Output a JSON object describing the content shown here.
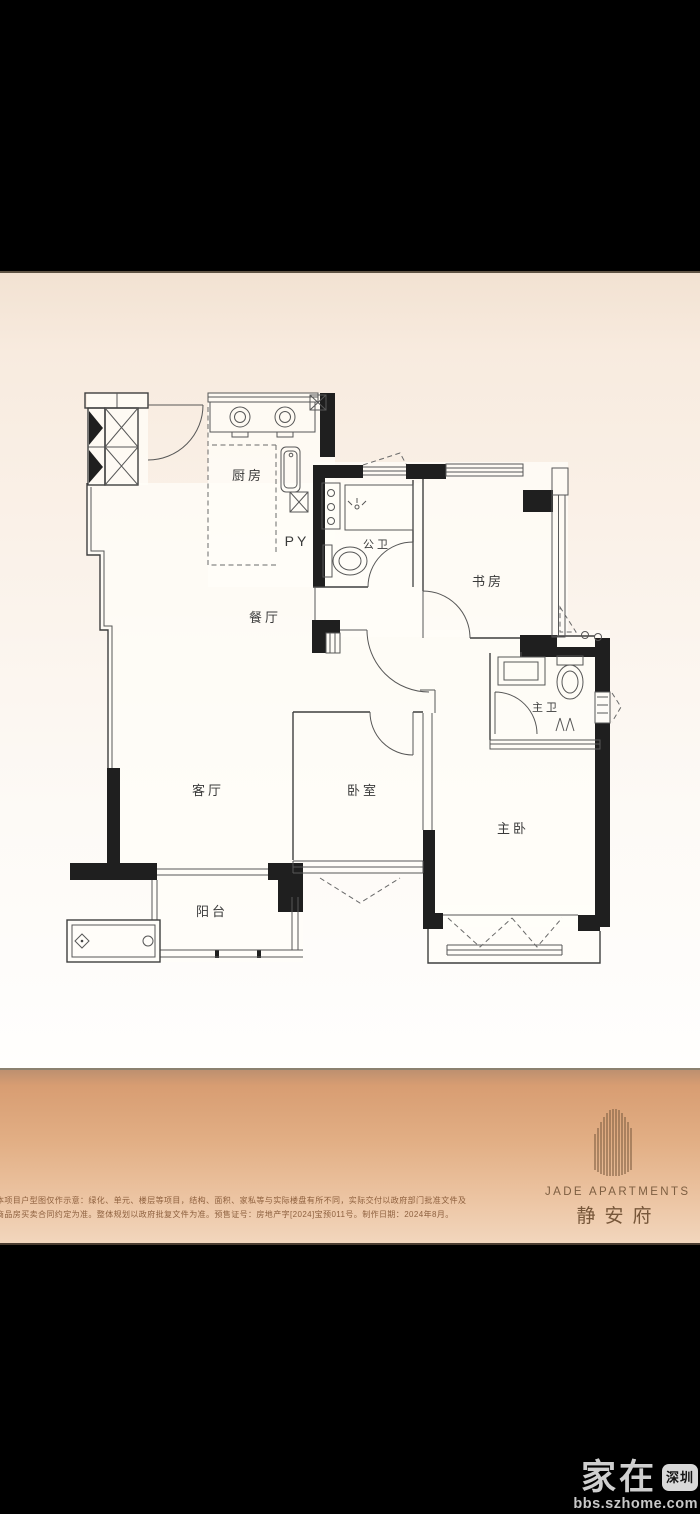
{
  "floor_plan": {
    "rooms": [
      {
        "id": "kitchen",
        "label": "厨房"
      },
      {
        "id": "dining-room",
        "label": "餐厅"
      },
      {
        "id": "living-room",
        "label": "客厅"
      },
      {
        "id": "balcony",
        "label": "阳台"
      },
      {
        "id": "bedroom",
        "label": "卧室"
      },
      {
        "id": "master-bedroom",
        "label": "主卧"
      },
      {
        "id": "study",
        "label": "书房"
      },
      {
        "id": "guest-bathroom",
        "label": "公卫"
      },
      {
        "id": "master-bathroom",
        "label": "主卫"
      }
    ],
    "annotations": {
      "pipe_shaft": "PY"
    }
  },
  "branding": {
    "logo_en": "JADE APARTMENTS",
    "logo_cn": "静安府"
  },
  "disclaimer": {
    "line1": "本项目户型图仅作示意：绿化、单元、楼层等项目，结构、面积、家私等与实际楼盘有所不同，实际交付以政府部门批准文件及",
    "line2": "商品房买卖合同约定为准。整体规划以政府批复文件为准。预售证号：房地产字[2024]宝预011号。制作日期：2024年8月。"
  },
  "watermark": {
    "site_name": "家在",
    "badge": "深圳",
    "url": "bbs.szhome.com"
  },
  "colors": {
    "band_top": "#d89d72",
    "band_bottom": "#f2d6bd",
    "photo_bg": "#f8ebdf",
    "wall": "#1f1f1f"
  }
}
